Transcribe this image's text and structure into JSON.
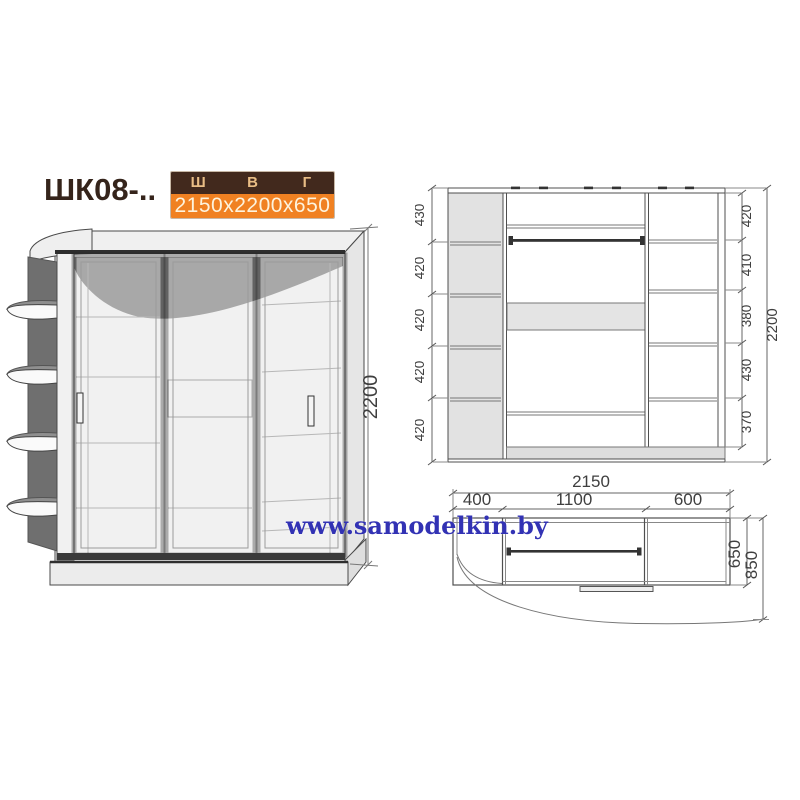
{
  "title": "ШК08-..",
  "spec": {
    "col_width_label": "Ш",
    "col_height_label": "В",
    "col_depth_label": "Г",
    "dimensions": "2150x2200x650"
  },
  "watermark": "www.samodelkin.by",
  "perspective": {
    "height": "2200"
  },
  "front": {
    "left_chain": [
      "430",
      "420",
      "420",
      "420",
      "420"
    ],
    "right_chain": [
      "420",
      "410",
      "380",
      "430",
      "370"
    ],
    "total_height": "2200"
  },
  "plan": {
    "total_width": "2150",
    "sections": [
      "400",
      "1100",
      "600"
    ],
    "depth": "650",
    "total_depth": "850"
  },
  "colors": {
    "accent_orange": "#f08122",
    "header_brown": "#42291d",
    "watermark_blue": "#3232b4",
    "panel_gray": "#e2e2e2",
    "dark_panel_gray": "#6f6f6f"
  }
}
